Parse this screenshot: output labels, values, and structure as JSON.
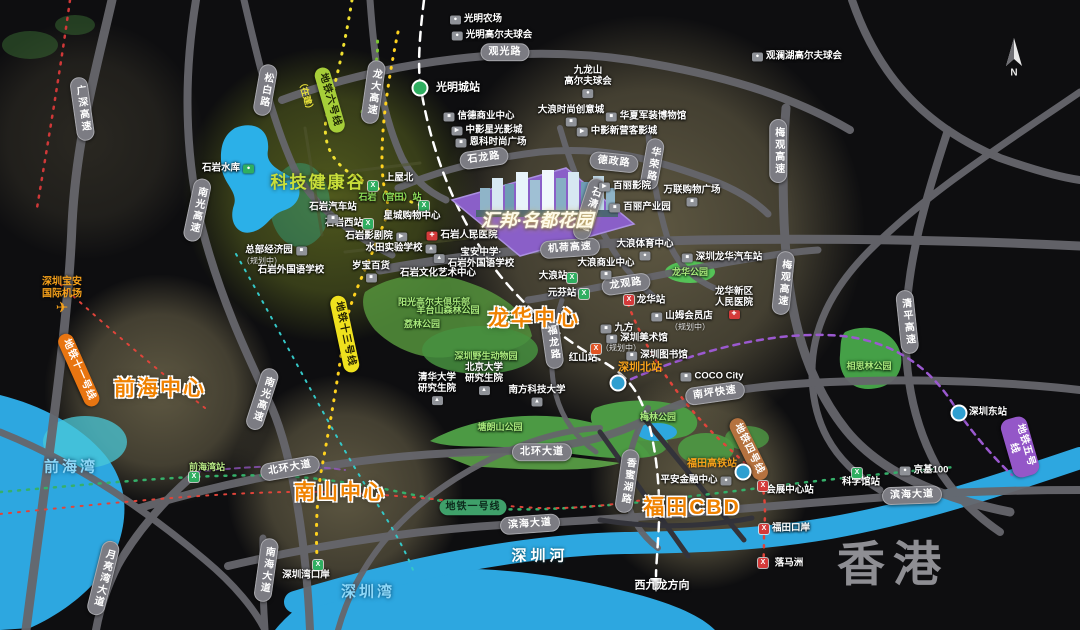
{
  "map_title": "汇邦·名都花园 区位示意图",
  "property": {
    "name": "汇邦·名都花园",
    "marker_color": "#8a5fc8"
  },
  "colors": {
    "background": "#0e0e10",
    "road": "#66666c",
    "water": "#2da7e0",
    "park": "#4c9a44",
    "accent_orange": "#f08200",
    "valley_green": "#c8de3a",
    "glow_khaki": "#cdbb87",
    "metro_line6": "#a6ce39",
    "metro_line13": "#efe11e",
    "metro_line11": "#e87511",
    "metro_line1": "#3fa06a",
    "metro_line4": "#b5723f",
    "metro_line5": "#9457c8"
  },
  "labels": [
    {
      "n": "road-guanguang-lu",
      "t": "观光路",
      "x": 505,
      "y": 52,
      "c": "road"
    },
    {
      "n": "road-songbai-lu",
      "t": "松白路",
      "x": 265,
      "y": 90,
      "c": "road",
      "v": 1,
      "r": 10
    },
    {
      "n": "road-guangshen-expressway",
      "t": "广深高速",
      "x": 82,
      "y": 109,
      "c": "road",
      "v": 1,
      "r": -8
    },
    {
      "n": "road-longda-expressway",
      "t": "龙大高速",
      "x": 373,
      "y": 92,
      "c": "road",
      "v": 1,
      "r": 8
    },
    {
      "n": "road-nanguang-expressway-north",
      "t": "南光高速",
      "x": 197,
      "y": 210,
      "c": "road",
      "v": 1,
      "r": 12
    },
    {
      "n": "road-shilong-lu",
      "t": "石龙路",
      "x": 484,
      "y": 158,
      "c": "road",
      "r": -8
    },
    {
      "n": "road-dezheng-lu",
      "t": "德政路",
      "x": 614,
      "y": 162,
      "c": "road",
      "r": 6
    },
    {
      "n": "road-huarong-lu",
      "t": "华荣路",
      "x": 652,
      "y": 164,
      "c": "road",
      "v": 1,
      "r": 10
    },
    {
      "n": "road-meiguan-expressway-north",
      "t": "梅观高速",
      "x": 778,
      "y": 151,
      "c": "road",
      "v": 1
    },
    {
      "n": "road-meiguan-expressway-south",
      "t": "梅观高速",
      "x": 783,
      "y": 283,
      "c": "road",
      "v": 1,
      "r": 6
    },
    {
      "n": "road-jihe-expressway",
      "t": "机荷高速",
      "x": 570,
      "y": 248,
      "c": "road",
      "r": -4
    },
    {
      "n": "road-longguan-lu",
      "t": "龙观路",
      "x": 626,
      "y": 284,
      "c": "road",
      "r": -8
    },
    {
      "n": "road-qingping-expressway",
      "t": "清平高速",
      "x": 907,
      "y": 322,
      "c": "road",
      "v": 1,
      "r": -6
    },
    {
      "n": "road-shiqing-avenue",
      "t": "石清大道",
      "x": 589,
      "y": 209,
      "c": "road",
      "v": 1,
      "r": 18
    },
    {
      "n": "road-fulong-lu",
      "t": "福龙路",
      "x": 552,
      "y": 343,
      "c": "road",
      "v": 1,
      "r": -8
    },
    {
      "n": "road-beihuan-avenue-west",
      "t": "北环大道",
      "x": 290,
      "y": 468,
      "c": "road",
      "r": -10
    },
    {
      "n": "road-beihuan-avenue-east",
      "t": "北环大道",
      "x": 542,
      "y": 452,
      "c": "road"
    },
    {
      "n": "road-nanping-expressway",
      "t": "南坪快速",
      "x": 715,
      "y": 393,
      "c": "road",
      "r": -8
    },
    {
      "n": "road-xiangmihu-lu",
      "t": "香蜜湖路",
      "x": 627,
      "y": 481,
      "c": "road",
      "v": 1,
      "r": 8
    },
    {
      "n": "road-binhai-avenue-west",
      "t": "滨海大道",
      "x": 530,
      "y": 524,
      "c": "road",
      "r": -4
    },
    {
      "n": "road-binhai-avenue-east",
      "t": "滨海大道",
      "x": 912,
      "y": 495,
      "c": "road",
      "r": -2
    },
    {
      "n": "road-yueliangwan-avenue",
      "t": "月亮湾大道",
      "x": 103,
      "y": 578,
      "c": "road",
      "v": 1,
      "r": 14
    },
    {
      "n": "road-nanhai-avenue",
      "t": "南海大道",
      "x": 266,
      "y": 570,
      "c": "road",
      "v": 1,
      "r": 8
    },
    {
      "n": "road-nanguang-expressway-south",
      "t": "南光高速",
      "x": 262,
      "y": 399,
      "c": "road",
      "v": 1,
      "r": 18
    },
    {
      "n": "metro-line6-label",
      "t": "地铁六号线",
      "x": 330,
      "y": 100,
      "c": "metro",
      "r": 74,
      "bg": "#a6ce39",
      "fg": "#1d2506"
    },
    {
      "n": "metro-line6-status",
      "t": "（在建）",
      "x": 306,
      "y": 96,
      "c": "plain-metro",
      "r": 74,
      "col": "#e8e13a"
    },
    {
      "n": "metro-line13-label",
      "t": "地铁十三号线",
      "x": 345,
      "y": 334,
      "c": "metro",
      "r": 78,
      "bg": "#efe11e",
      "fg": "#242102"
    },
    {
      "n": "metro-line11-label",
      "t": "地铁十一号线",
      "x": 79,
      "y": 370,
      "c": "metro",
      "r": 66,
      "bg": "#e87511",
      "fg": "#fff"
    },
    {
      "n": "metro-line1-label",
      "t": "地铁一号线",
      "x": 473,
      "y": 507,
      "c": "metro",
      "bg": "#3fa06a",
      "fg": "#0c2a1c"
    },
    {
      "n": "metro-line4-label",
      "t": "地铁四号线",
      "x": 749,
      "y": 449,
      "c": "metro",
      "r": 64,
      "bg": "#b5723f",
      "fg": "#fff"
    },
    {
      "n": "metro-line5-label",
      "t": "地铁五号线",
      "x": 1020,
      "y": 447,
      "c": "metro",
      "r": 74,
      "bg": "#9457c8",
      "fg": "#fff"
    },
    {
      "n": "area-qianhai-center",
      "t": "前海中心",
      "x": 160,
      "y": 389,
      "c": "area"
    },
    {
      "n": "area-nanshan-center",
      "t": "南山中心",
      "x": 340,
      "y": 493,
      "c": "area"
    },
    {
      "n": "area-longhua-center",
      "t": "龙华中心",
      "x": 534,
      "y": 319,
      "c": "area"
    },
    {
      "n": "area-futian-cbd",
      "t": "福田CBD",
      "x": 692,
      "y": 508,
      "c": "area"
    },
    {
      "n": "area-tech-health-valley",
      "t": "科技健康谷",
      "x": 318,
      "y": 183,
      "c": "valley"
    },
    {
      "n": "label-hongkong",
      "t": "香港",
      "x": 893,
      "y": 565,
      "c": "hk"
    },
    {
      "n": "water-qianhai-bay",
      "t": "前海湾",
      "x": 71,
      "y": 467,
      "c": "water"
    },
    {
      "n": "water-shenzhen-bay",
      "t": "深圳湾",
      "x": 368,
      "y": 592,
      "c": "water"
    },
    {
      "n": "water-shenzhen-river",
      "t": "深圳河",
      "x": 540,
      "y": 556,
      "c": "waterw"
    },
    {
      "n": "poi-shiyan-reservoir",
      "t": "石岩水库",
      "x": 228,
      "y": 169,
      "c": "poi",
      "i": "●",
      "ib": "#2fae60",
      "ip": "r"
    },
    {
      "n": "poi-baoan-airport",
      "t": "深圳宝安\n国际机场",
      "x": 62,
      "y": 296,
      "c": "orange",
      "i": "✈",
      "ib": "",
      "icol": "#f7a21b",
      "isz": 15,
      "ip": "t"
    },
    {
      "n": "station-shenzhen-north",
      "t": "深圳北站",
      "x": 640,
      "y": 368,
      "c": "orange-sta"
    },
    {
      "n": "icon-shenzhen-north-rail",
      "t": "",
      "x": 618,
      "y": 383,
      "c": "rail",
      "bg": "#2f9fd0"
    },
    {
      "n": "station-futian-hsr",
      "t": "福田高铁站",
      "x": 712,
      "y": 464,
      "c": "orange-sta",
      "fs": 10
    },
    {
      "n": "icon-futian-hsr-rail",
      "t": "",
      "x": 743,
      "y": 472,
      "c": "rail",
      "bg": "#2f9fd0"
    },
    {
      "n": "dir-west-kowloon",
      "t": "西九龙方向",
      "x": 662,
      "y": 586,
      "c": "dir"
    },
    {
      "n": "station-guangmingcheng",
      "t": "光明城站",
      "x": 458,
      "y": 88,
      "c": "station",
      "fs": 11
    },
    {
      "n": "icon-guangmingcheng-rail",
      "t": "",
      "x": 420,
      "y": 88,
      "c": "rail",
      "bg": "#2fae60"
    },
    {
      "n": "station-shangwubei",
      "t": "上屋北",
      "x": 399,
      "y": 179,
      "c": "station"
    },
    {
      "n": "icon-shangwubei-metro",
      "t": "",
      "x": 373,
      "y": 186,
      "c": "msta",
      "bg": "#2fae60",
      "i": "X"
    },
    {
      "n": "station-shiyan-guantian",
      "t": "石岩（官田）站",
      "x": 390,
      "y": 197,
      "c": "station",
      "col": "#8fe05a",
      "fs": 9
    },
    {
      "n": "icon-shiyan-guantian-metro",
      "t": "",
      "x": 424,
      "y": 206,
      "c": "msta",
      "bg": "#2fae60",
      "i": "X"
    },
    {
      "n": "station-qianhaiwan",
      "t": "前海湾站",
      "x": 207,
      "y": 467,
      "c": "station",
      "col": "#b8e986",
      "fs": 9
    },
    {
      "n": "icon-qianhaiwan-metro",
      "t": "",
      "x": 194,
      "y": 477,
      "c": "msta",
      "bg": "#2fae60",
      "i": "X"
    },
    {
      "n": "station-dalang",
      "t": "大浪站",
      "x": 553,
      "y": 277,
      "c": "station"
    },
    {
      "n": "icon-dalang-metro",
      "t": "",
      "x": 572,
      "y": 278,
      "c": "msta",
      "bg": "#2fae60",
      "i": "X"
    },
    {
      "n": "station-yuanfen",
      "t": "元芬站",
      "x": 562,
      "y": 294,
      "c": "station"
    },
    {
      "n": "icon-yuanfen-metro",
      "t": "",
      "x": 584,
      "y": 294,
      "c": "msta",
      "bg": "#2fae60",
      "i": "X"
    },
    {
      "n": "station-longhua",
      "t": "龙华站",
      "x": 651,
      "y": 301,
      "c": "station"
    },
    {
      "n": "icon-longhua-metro",
      "t": "",
      "x": 629,
      "y": 300,
      "c": "msta",
      "bg": "#d43a3a",
      "i": "X"
    },
    {
      "n": "station-hongshan",
      "t": "红山站",
      "x": 583,
      "y": 359,
      "c": "station"
    },
    {
      "n": "icon-hongshan-metro",
      "t": "",
      "x": 596,
      "y": 349,
      "c": "msta",
      "bg": "#e05424",
      "i": "X"
    },
    {
      "n": "station-convention-center",
      "t": "会展中心站",
      "x": 790,
      "y": 491,
      "c": "station"
    },
    {
      "n": "icon-convention-center-metro",
      "t": "",
      "x": 763,
      "y": 486,
      "c": "msta",
      "bg": "#d43a3a",
      "i": "X"
    },
    {
      "n": "station-science-museum",
      "t": "科学馆站",
      "x": 861,
      "y": 483,
      "c": "station"
    },
    {
      "n": "icon-science-museum-metro",
      "t": "",
      "x": 857,
      "y": 473,
      "c": "msta",
      "bg": "#2fae60",
      "i": "X"
    },
    {
      "n": "station-futian-checkpoint",
      "t": "福田口岸",
      "x": 791,
      "y": 529,
      "c": "station"
    },
    {
      "n": "icon-futian-checkpoint-metro",
      "t": "",
      "x": 764,
      "y": 529,
      "c": "msta",
      "bg": "#d43a3a",
      "i": "X"
    },
    {
      "n": "station-lok-ma-chau",
      "t": "落马洲",
      "x": 789,
      "y": 564,
      "c": "station"
    },
    {
      "n": "icon-lok-ma-chau-metro",
      "t": "",
      "x": 763,
      "y": 563,
      "c": "msta",
      "bg": "#d43a3a",
      "i": "X"
    },
    {
      "n": "station-shenzhen-east",
      "t": "深圳东站",
      "x": 988,
      "y": 413,
      "c": "station"
    },
    {
      "n": "icon-shenzhen-east-rail",
      "t": "",
      "x": 959,
      "y": 413,
      "c": "rail",
      "bg": "#2f9fd0"
    },
    {
      "n": "station-shenzhenwan-checkpoint",
      "t": "深圳湾口岸",
      "x": 306,
      "y": 576,
      "c": "station"
    },
    {
      "n": "icon-shenzhenwan-checkpoint-metro",
      "t": "",
      "x": 318,
      "y": 565,
      "c": "msta",
      "bg": "#2fae60",
      "i": "X"
    },
    {
      "n": "station-shiyan-west",
      "t": "石岩西站",
      "x": 344,
      "y": 224,
      "c": "station"
    },
    {
      "n": "icon-shiyan-west-metro",
      "t": "",
      "x": 368,
      "y": 224,
      "c": "msta",
      "bg": "#2fae60",
      "i": "X"
    },
    {
      "n": "poi-guangming-farm",
      "t": "光明农场",
      "x": 476,
      "y": 20,
      "c": "poi",
      "i": "●"
    },
    {
      "n": "poi-guangming-golf",
      "t": "光明高尔夫球会",
      "x": 492,
      "y": 36,
      "c": "poi",
      "i": "●"
    },
    {
      "n": "poi-mission-hills-golf",
      "t": "观澜湖高尔夫球会",
      "x": 797,
      "y": 57,
      "c": "poi",
      "i": "●"
    },
    {
      "n": "poi-jiulongshan-golf",
      "t": "九龙山\n高尔夫球会",
      "x": 588,
      "y": 82,
      "c": "poi",
      "i": "●",
      "ip": "b"
    },
    {
      "n": "poi-xinde-business-center",
      "t": "信德商业中心",
      "x": 479,
      "y": 117,
      "c": "poi",
      "i": "■"
    },
    {
      "n": "poi-zhongying-xingguang-cinema",
      "t": "中影星光影城",
      "x": 487,
      "y": 131,
      "c": "poi",
      "i": "▶"
    },
    {
      "n": "poi-enke-fashion-plaza",
      "t": "恩科时尚广场",
      "x": 491,
      "y": 143,
      "c": "poi",
      "i": "■"
    },
    {
      "n": "poi-dalang-fashion-town",
      "t": "大浪时尚创意城",
      "x": 571,
      "y": 116,
      "c": "poi",
      "i": "■",
      "ip": "b"
    },
    {
      "n": "poi-huaxia-military-museum",
      "t": "华夏军装博物馆",
      "x": 646,
      "y": 117,
      "c": "poi",
      "i": "■"
    },
    {
      "n": "poi-zhongying-xinyingke-cinema",
      "t": "中影新营客影城",
      "x": 617,
      "y": 132,
      "c": "poi",
      "i": "▶"
    },
    {
      "n": "poi-baili-cinema",
      "t": "百丽影院",
      "x": 625,
      "y": 187,
      "c": "poi",
      "i": "▶"
    },
    {
      "n": "poi-baili-industrial-park",
      "t": "百丽产业园",
      "x": 640,
      "y": 208,
      "c": "poi",
      "i": "■"
    },
    {
      "n": "poi-wanlian-shopping-plaza",
      "t": "万联购物广场",
      "x": 692,
      "y": 196,
      "c": "poi",
      "i": "■",
      "ip": "b"
    },
    {
      "n": "poi-shiyan-bus-station",
      "t": "石岩汽车站",
      "x": 333,
      "y": 213,
      "c": "poi",
      "i": "■",
      "ip": "t"
    },
    {
      "n": "poi-xingcheng-shopping-center",
      "t": "星城购物中心",
      "x": 412,
      "y": 217,
      "c": "poi"
    },
    {
      "n": "poi-shiyan-theater",
      "t": "石岩影剧院",
      "x": 376,
      "y": 237,
      "c": "poi",
      "i": "▶",
      "ip": "r"
    },
    {
      "n": "poi-shiyan-people-hospital",
      "t": "石岩人民医院",
      "x": 462,
      "y": 236,
      "c": "poi",
      "i": "✚",
      "ib": "#d43a3a"
    },
    {
      "n": "poi-shuitian-experimental-school",
      "t": "水田实验学校",
      "x": 401,
      "y": 249,
      "c": "poi",
      "i": "▲",
      "ip": "r"
    },
    {
      "n": "poi-baoan-middle-school",
      "t": "宝安中学·\n石岩外国语学校",
      "x": 474,
      "y": 259,
      "c": "poi",
      "i": "▲"
    },
    {
      "n": "poi-headquarters-economic-park",
      "t": "总部经济园",
      "x": 276,
      "y": 251,
      "c": "poi",
      "i": "■",
      "ip": "r"
    },
    {
      "n": "sub-headquarters-economic-park",
      "t": "（规划中）",
      "x": 262,
      "y": 261,
      "c": "sub"
    },
    {
      "n": "poi-shiyan-foreign-language-school",
      "t": "石岩外国语学校",
      "x": 291,
      "y": 271,
      "c": "poi"
    },
    {
      "n": "poi-suibao-department-store",
      "t": "岁宝百货",
      "x": 371,
      "y": 272,
      "c": "poi",
      "i": "■",
      "ip": "t"
    },
    {
      "n": "poi-shiyan-culture-art-center",
      "t": "石岩文化艺术中心",
      "x": 438,
      "y": 274,
      "c": "poi"
    },
    {
      "n": "poi-sunshine-golf-club",
      "t": "阳光高尔夫俱乐部",
      "x": 434,
      "y": 302,
      "c": "park"
    },
    {
      "n": "park-yangtaishan-forest",
      "t": "羊台山森林公园",
      "x": 448,
      "y": 310,
      "c": "park"
    },
    {
      "n": "park-lilin",
      "t": "荔林公园",
      "x": 422,
      "y": 324,
      "c": "park"
    },
    {
      "n": "poi-shenzhen-safari-park",
      "t": "深圳野生动物园",
      "x": 486,
      "y": 356,
      "c": "park"
    },
    {
      "n": "poi-pku-graduate-school",
      "t": "北京大学\n研究生院",
      "x": 484,
      "y": 379,
      "c": "poi",
      "i": "▲",
      "ip": "b"
    },
    {
      "n": "poi-tsinghua-graduate-school",
      "t": "清华大学\n研究生院",
      "x": 437,
      "y": 389,
      "c": "poi",
      "i": "▲",
      "ip": "b"
    },
    {
      "n": "poi-sustech",
      "t": "南方科技大学",
      "x": 537,
      "y": 396,
      "c": "poi",
      "i": "▲",
      "ip": "t"
    },
    {
      "n": "park-tanglangshan",
      "t": "塘朗山公园",
      "x": 500,
      "y": 427,
      "c": "park"
    },
    {
      "n": "park-meilin",
      "t": "梅林公园",
      "x": 658,
      "y": 417,
      "c": "park"
    },
    {
      "n": "park-xiangsilin",
      "t": "相思林公园",
      "x": 869,
      "y": 366,
      "c": "park"
    },
    {
      "n": "park-longhua",
      "t": "龙华公园",
      "x": 690,
      "y": 272,
      "c": "park"
    },
    {
      "n": "poi-dalang-sports-center",
      "t": "大浪体育中心",
      "x": 645,
      "y": 250,
      "c": "poi",
      "i": "●",
      "ip": "b"
    },
    {
      "n": "poi-longhua-bus-station",
      "t": "深圳龙华汽车站",
      "x": 722,
      "y": 258,
      "c": "poi",
      "i": "■"
    },
    {
      "n": "poi-dalang-business-center",
      "t": "大浪商业中心",
      "x": 606,
      "y": 269,
      "c": "poi",
      "i": "■",
      "ip": "t"
    },
    {
      "n": "poi-sams-club",
      "t": "山姆会员店",
      "x": 682,
      "y": 317,
      "c": "poi",
      "i": "■"
    },
    {
      "n": "sub-sams-club",
      "t": "（规划中）",
      "x": 690,
      "y": 327,
      "c": "sub"
    },
    {
      "n": "poi-longhua-district-hospital",
      "t": "龙华新区\n人民医院",
      "x": 734,
      "y": 303,
      "c": "poi",
      "i": "✚",
      "ib": "#d43a3a",
      "ip": "t"
    },
    {
      "n": "poi-jiufang-mall",
      "t": "九方",
      "x": 617,
      "y": 329,
      "c": "poi",
      "i": "■"
    },
    {
      "n": "poi-shenzhen-art-museum",
      "t": "深圳美术馆",
      "x": 637,
      "y": 339,
      "c": "poi",
      "i": "■"
    },
    {
      "n": "sub-shenzhen-art-museum",
      "t": "（规划中）",
      "x": 621,
      "y": 348,
      "c": "sub"
    },
    {
      "n": "poi-shenzhen-library",
      "t": "深圳图书馆",
      "x": 657,
      "y": 356,
      "c": "poi",
      "i": "■"
    },
    {
      "n": "poi-coco-city",
      "t": "COCO City",
      "x": 712,
      "y": 377,
      "c": "poi",
      "i": "■"
    },
    {
      "n": "poi-pingan-finance-center",
      "t": "平安金融中心",
      "x": 696,
      "y": 481,
      "c": "poi",
      "i": "●",
      "ip": "r"
    },
    {
      "n": "poi-kingkey-100",
      "t": "京基100",
      "x": 924,
      "y": 471,
      "c": "poi",
      "i": "●"
    },
    {
      "n": "property-title",
      "t": "汇邦·名都花园",
      "x": 537,
      "y": 221,
      "c": "prop"
    },
    {
      "n": "compass-n-label",
      "t": "N",
      "x": 1014,
      "y": 73,
      "c": "compass-n"
    }
  ]
}
